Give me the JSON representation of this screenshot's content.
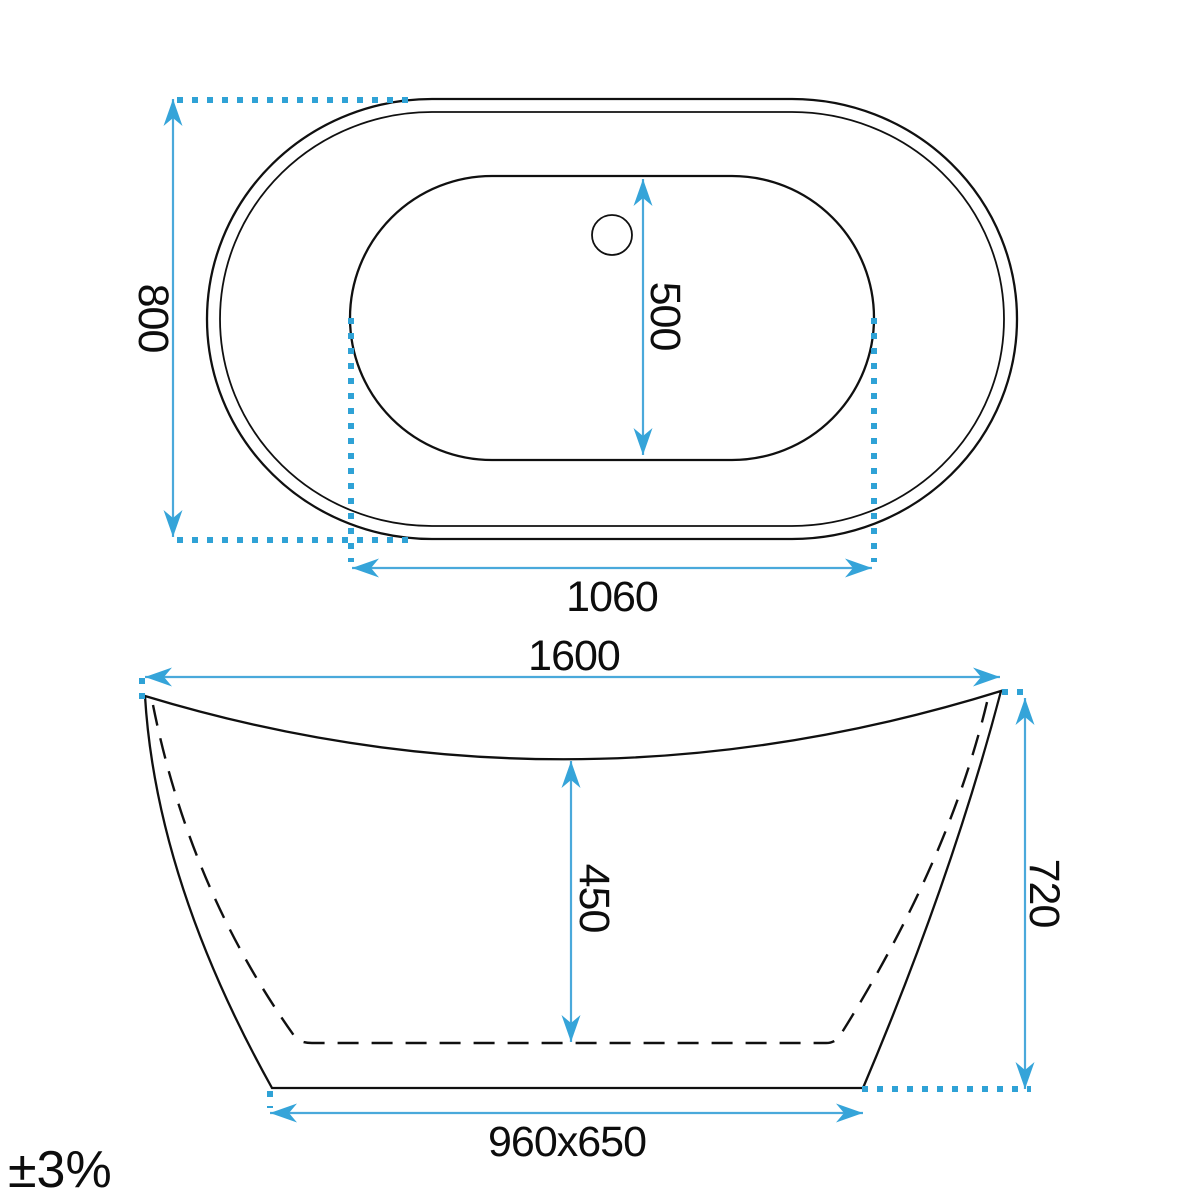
{
  "drawing": {
    "subject": "bathtub technical dimension drawing",
    "tolerance": "±3%",
    "colors": {
      "dimension_blue": "#4AA9DB",
      "arrow_blue": "#35A4D9",
      "dotted_blue": "#2FA2D6",
      "outline_black": "#101010",
      "background": "#FFFFFF"
    },
    "top_view": {
      "dim_overall_width": "800",
      "dim_basin_width": "500",
      "dim_basin_length": "1060"
    },
    "front_view": {
      "dim_overall_length": "1600",
      "dim_inner_depth": "450",
      "dim_overall_height": "720",
      "dim_base_size": "960x650"
    }
  }
}
